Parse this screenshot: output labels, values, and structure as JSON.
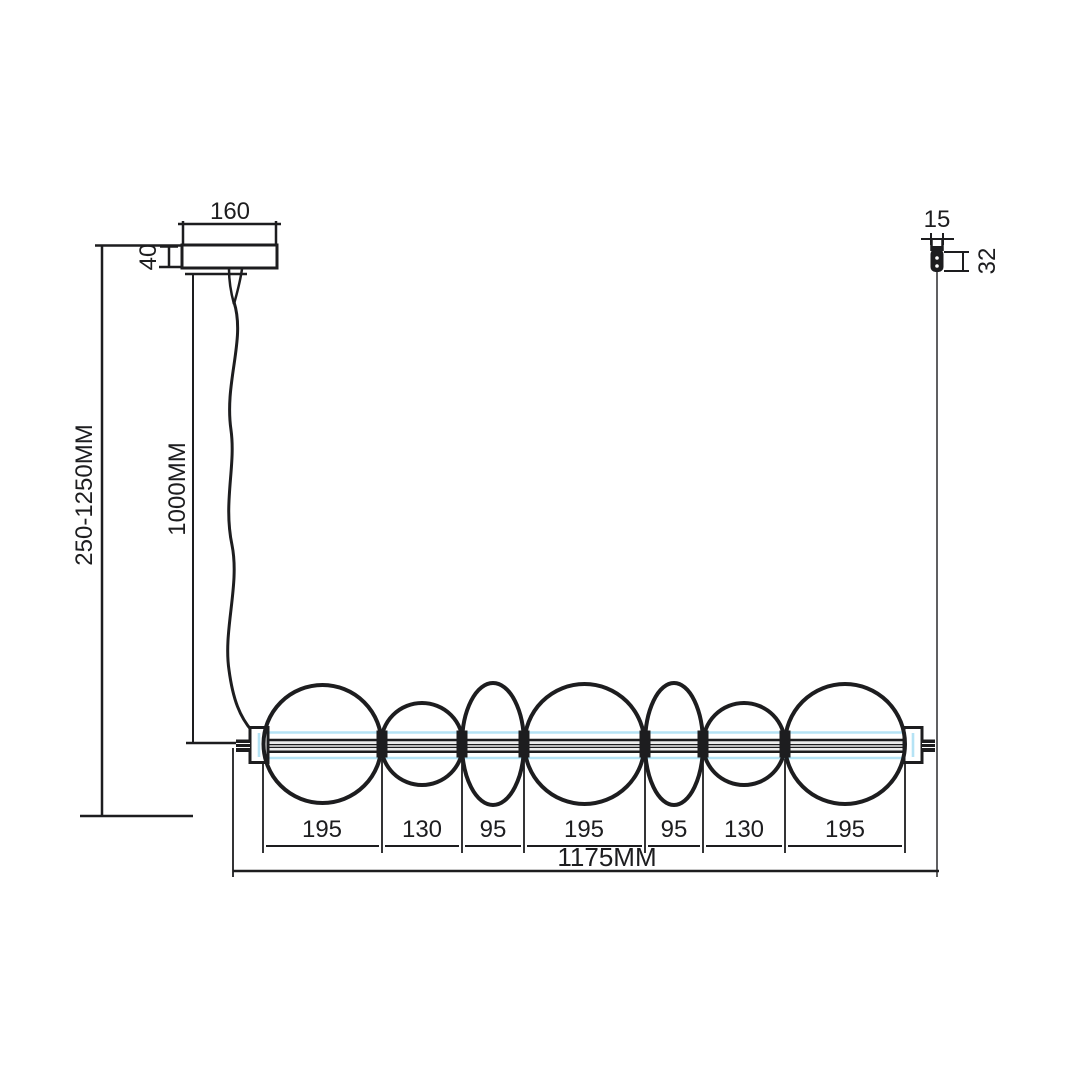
{
  "colors": {
    "line": "#1d1d1f",
    "glass_highlight": "#b5e3f5",
    "background": "#ffffff"
  },
  "canopy": {
    "width_label": "160",
    "height_label": "40"
  },
  "suspension": {
    "range_label": "250-1250MM",
    "cable_label": "1000MM"
  },
  "gripper": {
    "width_label": "15",
    "height_label": "32"
  },
  "fixture": {
    "overall_label": "1175MM",
    "segments": [
      {
        "label": "195"
      },
      {
        "label": "130"
      },
      {
        "label": "95"
      },
      {
        "label": "195"
      },
      {
        "label": "95"
      },
      {
        "label": "130"
      },
      {
        "label": "195"
      }
    ]
  }
}
